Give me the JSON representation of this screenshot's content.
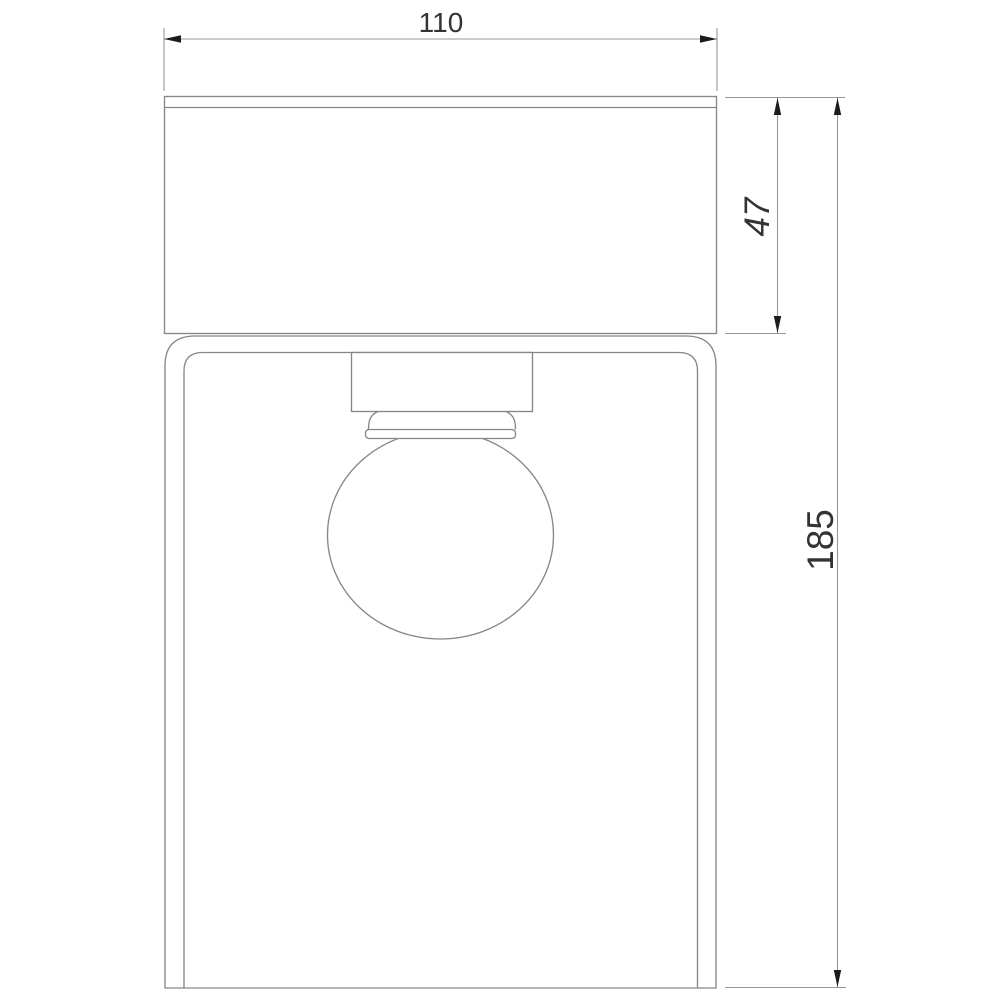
{
  "drawing": {
    "kind": "technical-dimension-drawing",
    "dimensions": {
      "width": {
        "value": "110"
      },
      "canopy_height": {
        "value": "47"
      },
      "total_height": {
        "value": "185"
      }
    },
    "colors": {
      "background": "#ffffff",
      "outline": "#878787",
      "dimension_line": "#979797",
      "arrow": "#1c1c1c",
      "label": "#333333"
    }
  }
}
